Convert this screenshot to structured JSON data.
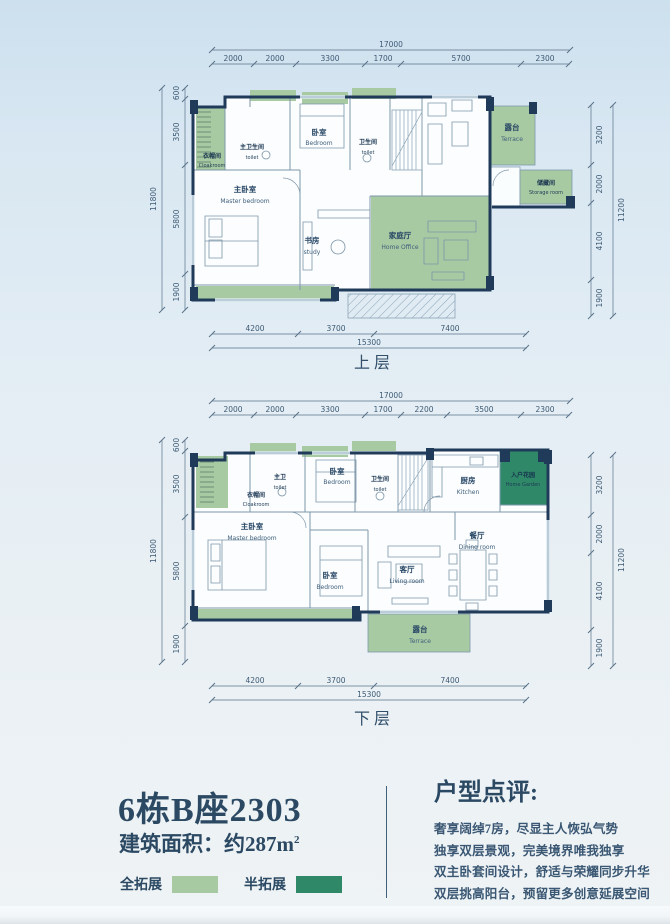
{
  "upper_plan": {
    "floor_label": "上层",
    "dims": {
      "top_total": "17000",
      "top": [
        "2000",
        "2000",
        "3300",
        "1700",
        "5700",
        "2300"
      ],
      "left_total": "11800",
      "left": [
        "600",
        "3500",
        "5800",
        "1900"
      ],
      "right_total": "11200",
      "right": [
        "3200",
        "2000",
        "4100",
        "1900"
      ],
      "bottom": [
        "4200",
        "3700",
        "7400"
      ],
      "bottom_total": "15300"
    },
    "rooms": {
      "cloakroom": {
        "zh": "衣帽间",
        "en": "Cloakroom"
      },
      "master_toilet": {
        "zh": "主卫生间",
        "en": "toilet"
      },
      "bedroom": {
        "zh": "卧室",
        "en": "Bedroom"
      },
      "toilet": {
        "zh": "卫生间",
        "en": "toilet"
      },
      "master_bedroom": {
        "zh": "主卧室",
        "en": "Master bedroom"
      },
      "study": {
        "zh": "书房",
        "en": "study"
      },
      "home_office": {
        "zh": "家庭厅",
        "en": "Home Office"
      },
      "terrace": {
        "zh": "露台",
        "en": "Terrace"
      },
      "storage": {
        "zh": "储藏间",
        "en": "Storage room"
      }
    }
  },
  "lower_plan": {
    "floor_label": "下层",
    "dims": {
      "top_total": "17000",
      "top": [
        "2000",
        "2000",
        "3300",
        "1700",
        "2200",
        "3500",
        "2300"
      ],
      "left_total": "11800",
      "left": [
        "600",
        "3500",
        "5800",
        "1900"
      ],
      "right_total": "11200",
      "right": [
        "3200",
        "2000",
        "4100",
        "1900"
      ],
      "bottom": [
        "4200",
        "3700",
        "7400"
      ],
      "bottom_total": "15300"
    },
    "rooms": {
      "cloakroom": {
        "zh": "衣帽间",
        "en": "Cloakroom"
      },
      "master_toilet": {
        "zh": "主卫",
        "en": "toilet"
      },
      "bedroom_top": {
        "zh": "卧室",
        "en": "Bedroom"
      },
      "toilet": {
        "zh": "卫生间",
        "en": "toilet"
      },
      "kitchen": {
        "zh": "厨房",
        "en": "Kitchen"
      },
      "home_garden": {
        "zh": "入户花园",
        "en": "Home Garden"
      },
      "master_bedroom": {
        "zh": "主卧室",
        "en": "Master bedroom"
      },
      "bedroom_bottom": {
        "zh": "卧室",
        "en": "Bedroom"
      },
      "living_room": {
        "zh": "客厅",
        "en": "Living room"
      },
      "dining_room": {
        "zh": "餐厅",
        "en": "Dining room"
      },
      "terrace": {
        "zh": "露台",
        "en": "Terrace"
      }
    }
  },
  "info": {
    "unit_title": "6栋B座2303",
    "area_label": "建筑面积：约287m",
    "area_superscript": "2",
    "legend": {
      "full_expand": "全拓展",
      "half_expand": "半拓展"
    },
    "review_title": "户型点评:",
    "review_lines": [
      "奢享阔绰7房，尽显主人恢弘气势",
      "独享双层景观，完美境界唯我独享",
      "双主卧套间设计，舒适与荣耀同步升华",
      "双层挑高阳台，预留更多创意延展空间"
    ]
  },
  "colors": {
    "full_expand_green": "#a8caa3",
    "half_expand_green": "#2f8968",
    "wall_navy": "#203a5a"
  }
}
